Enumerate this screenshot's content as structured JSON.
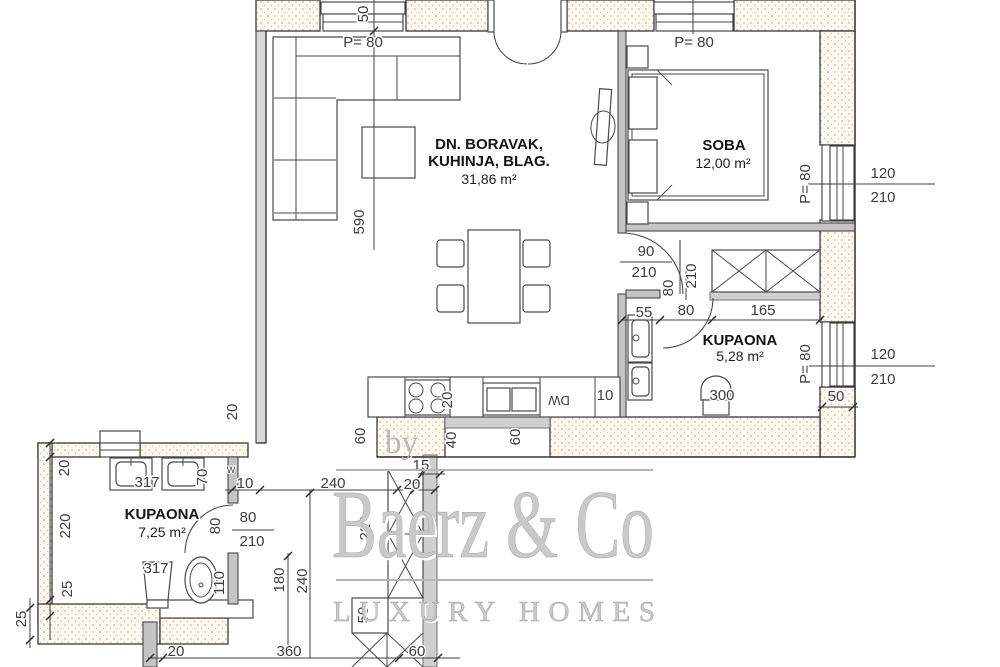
{
  "watermark": {
    "by": "by",
    "brand": "Baerz & Co",
    "tagline": "LUXURY HOMES"
  },
  "rooms": [
    {
      "name": "DN. BORAVAK,",
      "name2": "KUHINJA, BLAG.",
      "area": "31,86 m²"
    },
    {
      "name": "SOBA",
      "area": "12,00 m²"
    },
    {
      "name": "KUPAONA",
      "area": "5,28 m²"
    },
    {
      "name": "KUPAONA",
      "area": "7,25 m²"
    }
  ],
  "dims": [
    "P= 80",
    "50",
    "590",
    "P= 80",
    "P= 80",
    "120",
    "210",
    "P= 80",
    "120",
    "210",
    "50",
    "90",
    "210",
    "80",
    "210",
    "55",
    "80",
    "165",
    "300",
    "10",
    "20",
    "60",
    "40",
    "60",
    "15",
    "20",
    "240",
    "10",
    "20",
    "20",
    "220",
    "25",
    "25",
    "70",
    "80",
    "210",
    "80",
    "110",
    "180",
    "240",
    "220",
    "50",
    "20",
    "360",
    "60"
  ],
  "fixtures": {
    "codes": [
      "317",
      "317"
    ],
    "dishwasher": "DW",
    "washer_mark": "W"
  }
}
